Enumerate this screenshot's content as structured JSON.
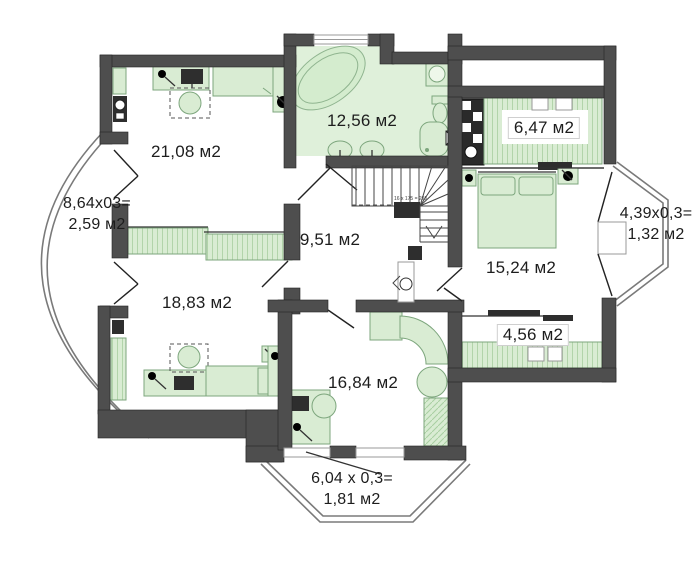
{
  "title": "apartment-floor-plan",
  "rooms": [
    {
      "id": "room-2108",
      "area_label": "21,08 м2"
    },
    {
      "id": "bathroom",
      "area_label": "12,56 м2"
    },
    {
      "id": "wardrobe-647",
      "area_label": "6,47 м2"
    },
    {
      "id": "hall",
      "area_label": "9,51 м2"
    },
    {
      "id": "bedroom-1524",
      "area_label": "15,24 м2"
    },
    {
      "id": "loggia-456",
      "area_label": "4,56 м2"
    },
    {
      "id": "room-1883",
      "area_label": "18,83 м2"
    },
    {
      "id": "room-1684",
      "area_label": "16,84 м2"
    }
  ],
  "balconies": [
    {
      "id": "balcony-left",
      "line1": "8,64x03=",
      "line2": "2,59 м2"
    },
    {
      "id": "balcony-right",
      "line1": "4,39x0,3=",
      "line2": "1,32 м2"
    },
    {
      "id": "balcony-bottom",
      "line1": "6,04 x 0,3=",
      "line2": "1,81 м2"
    }
  ],
  "stairs": {
    "note": "16 x 175 = 295"
  },
  "colors": {
    "wall": "#4e4e4e",
    "furniture_fill": "#d9ecd3",
    "furniture_stroke": "#7da67d",
    "bathroom_floor": "#dff0da",
    "line": "#333333",
    "railing": "#7a7a7a"
  }
}
